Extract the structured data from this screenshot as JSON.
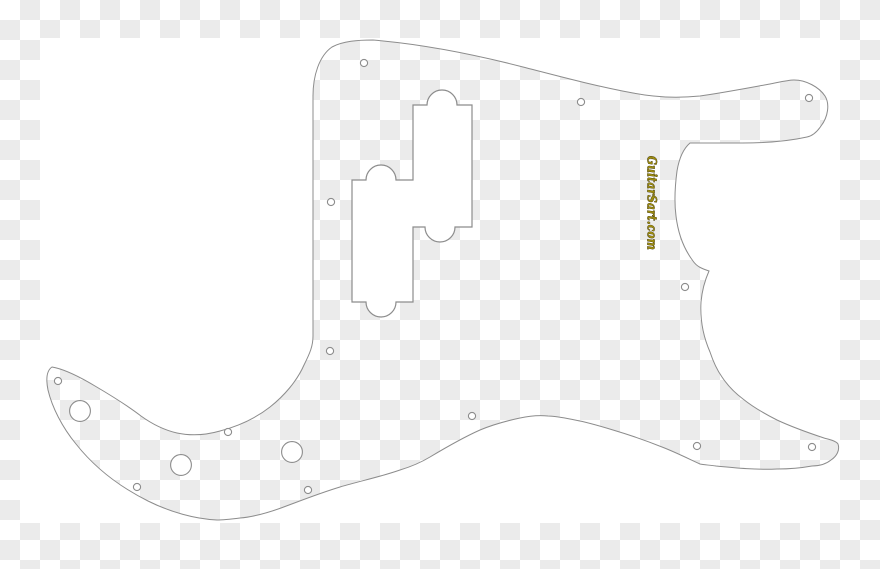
{
  "canvas": {
    "width": 880,
    "height": 569
  },
  "colors": {
    "checker_light": "#ffffff",
    "checker_dark": "#ebebeb",
    "artwork_fill": "#ffffff",
    "outline": "#8c8c8c"
  },
  "artwork": {
    "description_name": "precision-bass-pickguard-template",
    "watermark": {
      "text": "GuitarSart.com",
      "fill": "#9c8b10",
      "outline": "#32290a"
    }
  },
  "paths": {
    "pickguard": "M373,40 C420,44 473,54 523,67 C558,76 595,86 633,93 C658,98 680,98 700,96 C722,93 748,88 770,84 C780,82 788,80 794,80 C806,80 819,87 825,96 C830,104 828,117 821,126 C817,132 812,136 807,137 C789,141 765,143 742,143 C724,143 705,143 690,143 C683,149 679,159 677,171 C675,186 674,201 676,216 C678,233 684,249 693,261 C697,267 703,269 709,271 C705,280 702,291 701,302 C700,319 703,336 710,352 C713,361 717,370 722,377 C728,386 735,393 743,399 C753,407 765,414 777,420 C794,428 812,434 824,438 C831,440 836,441 838,444 C840,450 837,456 831,460 C826,464 819,466 812,466 C801,468 789,469 777,469 C757,470 736,468 716,466 C710,465 704,465 700,464 C687,458 675,452 662,447 C647,441 630,435 613,430 C600,426 586,422 575,420 C565,418 556,416 548,416 C538,415 529,416 520,418 C506,421 492,425 480,430 C462,438 445,448 430,457 C420,463 410,467 400,470 C380,477 360,481 340,487 C320,493 300,501 281,508 C267,513 253,517 240,518 C232,519 224,520 217,520 C195,519 170,512 148,501 C120,487 95,468 76,444 C62,427 52,407 48,390 C46,380 46,371 52,367 C64,369 80,377 95,386 C112,396 128,406 141,416 C152,424 164,430 177,433 C191,436 206,435 220,431 C239,426 256,418 270,407 C284,396 297,381 304,365 C310,353 313,346 313,336 C313,256 313,176 313,96 C313,76 319,56 332,47 C343,41 358,40 373,40 Z",
    "canvas_with_cutout": "M40,38 L840,38 L840,523 L20,523 L20,341 L40,341 Z M373,40 C420,44 473,54 523,67 C558,76 595,86 633,93 C658,98 680,98 700,96 C722,93 748,88 770,84 C780,82 788,80 794,80 C806,80 819,87 825,96 C830,104 828,117 821,126 C817,132 812,136 807,137 C789,141 765,143 742,143 C724,143 705,143 690,143 C683,149 679,159 677,171 C675,186 674,201 676,216 C678,233 684,249 693,261 C697,267 703,269 709,271 C705,280 702,291 701,302 C700,319 703,336 710,352 C713,361 717,370 722,377 C728,386 735,393 743,399 C753,407 765,414 777,420 C794,428 812,434 824,438 C831,440 836,441 838,444 C840,450 837,456 831,460 C826,464 819,466 812,466 C801,468 789,469 777,469 C757,470 736,468 716,466 C710,465 704,465 700,464 C687,458 675,452 662,447 C647,441 630,435 613,430 C600,426 586,422 575,420 C565,418 556,416 548,416 C538,415 529,416 520,418 C506,421 492,425 480,430 C462,438 445,448 430,457 C420,463 410,467 400,470 C380,477 360,481 340,487 C320,493 300,501 281,508 C267,513 253,517 240,518 C232,519 224,520 217,520 C195,519 170,512 148,501 C120,487 95,468 76,444 C62,427 52,407 48,390 C46,380 46,371 52,367 C64,369 80,377 95,386 C112,396 128,406 141,416 C152,424 164,430 177,433 C191,436 206,435 220,431 C239,426 256,418 270,407 C284,396 297,381 304,365 C310,353 313,346 313,336 C313,256 313,176 313,96 C313,76 319,56 332,47 C343,41 358,40 373,40 Z",
    "pickup_rout": "M352,180 L366,180 A15,15 0 0 1 396,180 L413,180 L413,105 L427,105 A15,15 0 0 1 457,105 L472,105 L472,227 L455,227 A15,15 0 0 1 425,227 L413,227 L413,302 L396,302 A15,15 0 0 1 366,302 L352,302 Z"
  },
  "holes": {
    "screw_radius": 3.6,
    "control_radius": 10.4,
    "screws": [
      [
        364,
        63
      ],
      [
        581,
        102
      ],
      [
        809,
        98
      ],
      [
        331,
        202
      ],
      [
        330,
        351
      ],
      [
        685,
        287
      ],
      [
        58,
        381
      ],
      [
        137,
        487
      ],
      [
        228,
        432
      ],
      [
        308,
        490
      ],
      [
        472,
        416
      ],
      [
        697,
        446
      ],
      [
        812,
        447
      ]
    ],
    "controls": [
      [
        80,
        411
      ],
      [
        181,
        465
      ],
      [
        292,
        452
      ]
    ]
  },
  "watermark_position": {
    "x": 651,
    "y": 203,
    "rotation": 90
  }
}
